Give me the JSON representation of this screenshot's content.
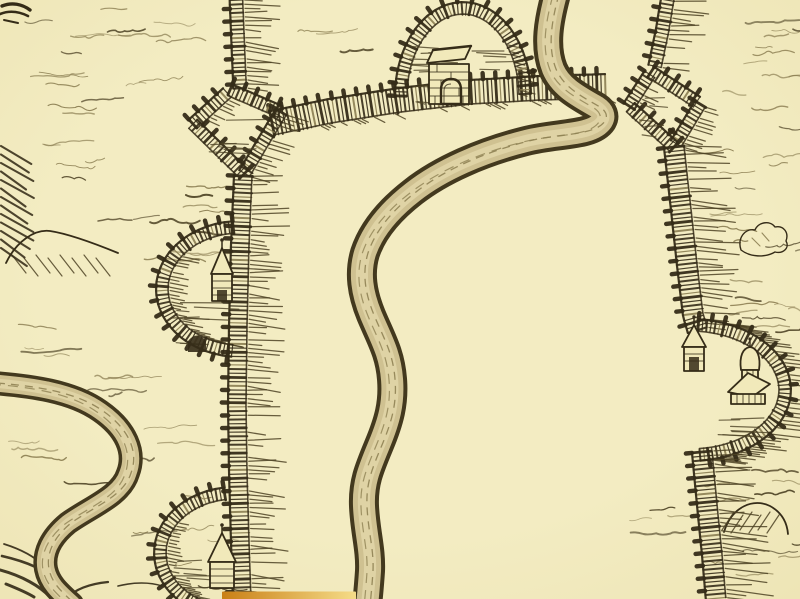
{
  "artwork": {
    "type": "engraved-map-detail",
    "title": "Engraved map detail: palisaded fortification with corner bastions, gate ravelin, watchtowers and a winding river",
    "style": "hand-engraved etching on parchment",
    "has_visible_text": false
  },
  "palette": {
    "parchment": "#f3ecc2",
    "parchment2": "#f1e9ba",
    "parchment_edge": "#e7dca6",
    "ink": "#352c18",
    "ink_light": "#8b7e52",
    "shadow": "#4e4325",
    "water_edge": "#43391e",
    "water_fill": "#cfc191",
    "water_light": "#e2d6a8",
    "water_detail": "#8f8254",
    "strip_dark": "#c97f16",
    "strip_light": "#f5dc88"
  },
  "features": {
    "enclosure": "palisaded enclosure wall with crenellations",
    "gate": "north gate ravelin with masonry gatehouse and arched doorway",
    "bastion_nw": "square corner bastion north-west",
    "bastion_ne": "square corner bastion north-east",
    "bastion_w_upper": "semicircular flank bastion west (upper) with spired watchtower",
    "bastion_w_lower": "semicircular flank bastion west (lower) with spired watchtower",
    "bastion_e": "semicircular flank bastion east with wall tower, domed turret and house",
    "river": "river entering from the north and winding south through the enclosure",
    "stream": "stream meandering outside the west wall",
    "terrain": "etched terrain hatching, hills, mound and shrub",
    "strip": "amber accent strip at bottom edge"
  }
}
